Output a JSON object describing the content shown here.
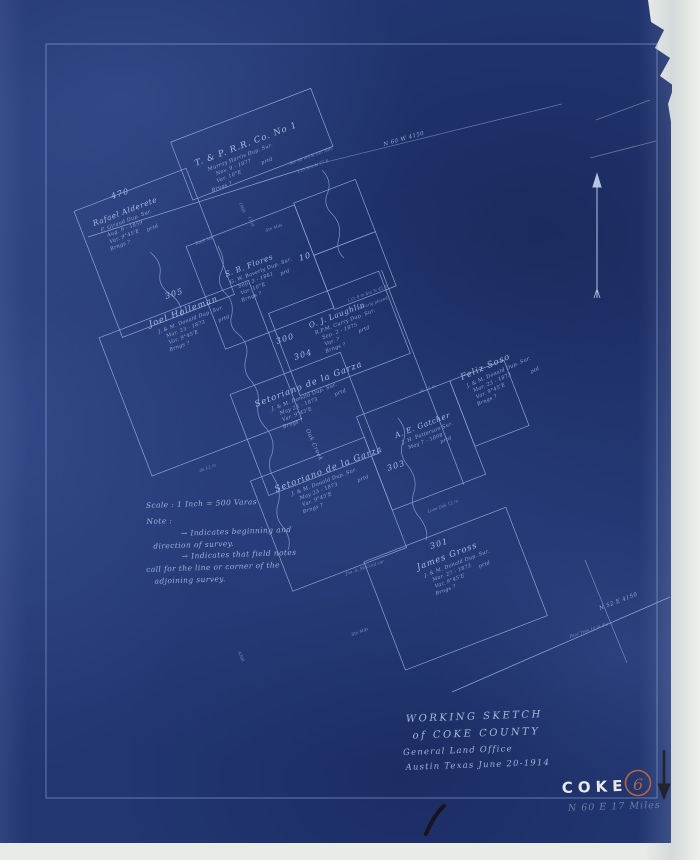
{
  "palette": {
    "blueprint_blue": "#223672",
    "line_blue": "#92a8d6",
    "chalk_white": "#e9eae6",
    "sheet_no_orange": "#b5653c",
    "pencil_gray": "#6d80a0",
    "ink_black": "#15151d"
  },
  "title": {
    "l1": "WORKING  SKETCH",
    "l2": "of COKE  COUNTY",
    "l3": "General  Land  Office",
    "l4": "Austin Texas  June 20-1914"
  },
  "marks": {
    "coke": "COKE",
    "sheet_no": "6",
    "miles": "N 60 E  17 Miles"
  },
  "notes": {
    "scale": "Scale :   1 Inch = 500 Varas",
    "heading": "Note :",
    "l1": "→ Indicates beginning and",
    "l2": "direction of survey.",
    "l3": "→ Indicates that field notes",
    "l4": "call for the line or corner of the",
    "l5": "adjoining survey."
  },
  "surveys": [
    {
      "name": "T. & P. R.R. Co.  No 1",
      "l1": "Murray Harris Dup. Sur.",
      "l2": "Nov. 9 - 1877",
      "l3": "Var. 10°E",
      "l4": "Brngs ?",
      "ptd": "prtd"
    },
    {
      "name": "Rafael Alderete",
      "l1": "F. Giraud Dup. Sur.",
      "l2": "Aug. 9 - 1859",
      "l3": "Var. 9°45'E",
      "l4": "Brngs ?",
      "ptd": "prtd"
    },
    {
      "name": "S. B. Flores",
      "l1": "G. W. Baverly Dup. Sur.",
      "l2": "Sep. 3 - 1861",
      "l3": "Var. 10°E",
      "l4": "Brngs ?",
      "ptd": "prd"
    },
    {
      "name": "Joel  Holleman",
      "l1": "J. & M. Donald Dup. Sur.",
      "l2": "Mar. 23 - 1873",
      "l3": "Var. 9°45'E",
      "l4": "Brngs ?",
      "ptd": "prtd"
    },
    {
      "name": "O. J. Laughlin",
      "l1": "R.P.M. Curry Dup. Sur.",
      "l2": "Sep. 2 - 1875",
      "l3": "Var. ?",
      "l4": "Brngs ?",
      "ptd": "prtd"
    },
    {
      "name": "Setoriano  de  la  Garza",
      "l1": "J. & M. Donald Dup. Sur.",
      "l2": "May 23 - 1873",
      "l3": "Var. 9°45'E",
      "l4": "Brngs ?",
      "ptd": "prtd"
    },
    {
      "name": "Setoriano  de  la  Garza",
      "l1": "J. & M. Donald Dup. Sur.",
      "l2": "May 23 - 1873",
      "l3": "Var. 9°45'E",
      "l4": "Brngs ?",
      "ptd": "prtd"
    },
    {
      "name": "A. E. Gatcher",
      "l1": "J. H. Patterson Sur.",
      "l2": "May 7 - 1898",
      "l3": "",
      "l4": "",
      "ptd": "prtd"
    },
    {
      "name": "James  Gross",
      "l1": "J. & M. Donald Dup. Sur.",
      "l2": "Mar. 27 - 1873",
      "l3": "Var. 9°45'E",
      "l4": "Brngs ?",
      "ptd": "prtd"
    },
    {
      "name": "Feliz  Soso",
      "l1": "J. & M. Donald Dup. Sur.",
      "l2": "Mar. 23 - 1873",
      "l3": "Var. 9°45'E",
      "l4": "Brngs ?",
      "ptd": "ptd"
    }
  ],
  "numbers": [
    "470",
    "305",
    "10",
    "300",
    "304",
    "303",
    "301"
  ],
  "labels": {
    "top_line": "N 60 W  4150",
    "bottom_line": "N 52 E  4150",
    "creek": "Oak Creek",
    "m1900": "1900",
    "m1139": "1139",
    "v4300": "4300"
  },
  "micro": [
    "Set 95 vrs & Stn Mds",
    "L.O. brs N 77 E",
    "Rock Md",
    "Stn Mds",
    "L.O. 8 in brs N 45 E",
    "cor orig placed",
    "do 12 in",
    "Pear Tree 10 in dia",
    "Jno. A. McCord cor",
    "Lone Oak 12 in"
  ]
}
